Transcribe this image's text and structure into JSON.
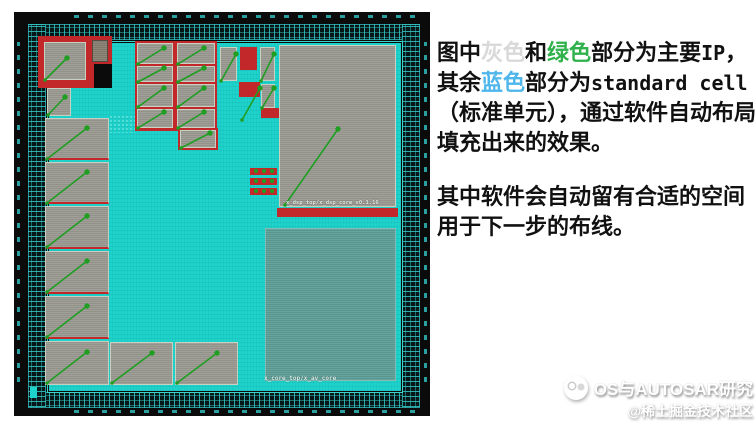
{
  "article": {
    "p1_runs": [
      {
        "text": "图中"
      },
      {
        "text": "灰色",
        "color": "#d9d9d9"
      },
      {
        "text": "和"
      },
      {
        "text": "绿色",
        "color": "#2fb14c"
      },
      {
        "text": "部分为主要"
      },
      {
        "text": "IP",
        "mono": true
      },
      {
        "text": "，其余"
      },
      {
        "text": "蓝色",
        "color": "#4fb6ec"
      },
      {
        "text": "部分为"
      },
      {
        "text": "standard cell",
        "mono": true
      },
      {
        "text": "（标准单元），通过软件自动布局填充出来的效果。"
      }
    ],
    "p2": "其中软件会自动留有合适的空间用于下一步的布线。"
  },
  "watermark": {
    "brand": "OS与AUTOSAR研究",
    "handle": "@稀土掘金技术社区"
  },
  "chip": {
    "colors": {
      "die_black": "#0b0b0b",
      "core_cyan": "#1ed3cb",
      "macro_gray": "#9b9b93",
      "macro_dark": "#877f72",
      "sage": "#5f9f98",
      "red": "#c2282a",
      "green": "#1f9e22",
      "pad_teal": "#35c3c3"
    },
    "labels": {
      "top_block": "x_dsp_top/x_dsp_core_v0.1.16",
      "core_bottom": "x_core_top/x_av_core"
    },
    "red_shapes": [
      [
        24,
        24,
        74,
        38
      ],
      [
        24,
        56,
        58,
        20
      ],
      [
        121,
        29,
        82,
        90
      ],
      [
        164,
        116,
        40,
        22
      ],
      [
        226,
        35,
        17,
        23
      ],
      [
        225,
        70,
        21,
        15
      ],
      [
        247,
        96,
        20,
        10
      ],
      [
        263,
        196,
        121,
        9
      ]
    ],
    "black_shapes": [
      [
        80,
        52,
        18,
        24
      ]
    ],
    "blocks": [
      {
        "x": 30,
        "y": 30,
        "w": 42,
        "h": 38,
        "t": "macro"
      },
      {
        "x": 78,
        "y": 28,
        "w": 16,
        "h": 22,
        "t": "dark"
      },
      {
        "x": 33,
        "y": 76,
        "w": 24,
        "h": 28,
        "t": "macro"
      },
      {
        "x": 31,
        "y": 106,
        "w": 64,
        "h": 42,
        "t": "macro",
        "sep": true
      },
      {
        "x": 31,
        "y": 150,
        "w": 64,
        "h": 42,
        "t": "macro",
        "sep": true
      },
      {
        "x": 31,
        "y": 194,
        "w": 64,
        "h": 43,
        "t": "macro",
        "sep": true
      },
      {
        "x": 31,
        "y": 239,
        "w": 64,
        "h": 43,
        "t": "macro",
        "sep": true
      },
      {
        "x": 31,
        "y": 284,
        "w": 64,
        "h": 43,
        "t": "macro",
        "sep": true
      },
      {
        "x": 31,
        "y": 329,
        "w": 64,
        "h": 44,
        "t": "macro"
      },
      {
        "x": 96,
        "y": 330,
        "w": 63,
        "h": 43,
        "t": "macro"
      },
      {
        "x": 161,
        "y": 330,
        "w": 63,
        "h": 43,
        "t": "macro"
      },
      {
        "x": 123,
        "y": 31,
        "w": 36,
        "h": 21,
        "t": "macro"
      },
      {
        "x": 163,
        "y": 31,
        "w": 38,
        "h": 21,
        "t": "macro"
      },
      {
        "x": 123,
        "y": 54,
        "w": 36,
        "h": 16,
        "t": "macro"
      },
      {
        "x": 163,
        "y": 54,
        "w": 38,
        "h": 16,
        "t": "macro"
      },
      {
        "x": 123,
        "y": 72,
        "w": 36,
        "h": 23,
        "t": "macro"
      },
      {
        "x": 163,
        "y": 72,
        "w": 38,
        "h": 23,
        "t": "macro"
      },
      {
        "x": 123,
        "y": 97,
        "w": 36,
        "h": 19,
        "t": "macro"
      },
      {
        "x": 163,
        "y": 97,
        "w": 38,
        "h": 19,
        "t": "macro"
      },
      {
        "x": 166,
        "y": 118,
        "w": 36,
        "h": 18,
        "t": "macro"
      },
      {
        "x": 206,
        "y": 35,
        "w": 17,
        "h": 34,
        "t": "macro"
      },
      {
        "x": 246,
        "y": 35,
        "w": 15,
        "h": 34,
        "t": "macro"
      },
      {
        "x": 247,
        "y": 72,
        "w": 14,
        "h": 24,
        "t": "macro"
      },
      {
        "x": 265,
        "y": 33,
        "w": 117,
        "h": 162,
        "t": "big"
      },
      {
        "x": 251,
        "y": 216,
        "w": 131,
        "h": 153,
        "t": "sage"
      }
    ],
    "pad_cluster": {
      "bars": [
        [
          236,
          156,
          27,
          7
        ],
        [
          236,
          166,
          27,
          7
        ],
        [
          236,
          176,
          27,
          7
        ]
      ],
      "dots_dx": [
        4,
        12,
        20
      ]
    },
    "texture_patch": [
      95,
      103,
      26,
      18
    ],
    "arrows": [
      [
        31,
        68,
        53,
        46
      ],
      [
        34,
        103,
        51,
        85
      ],
      [
        33,
        147,
        73,
        116
      ],
      [
        33,
        191,
        73,
        160
      ],
      [
        33,
        235,
        73,
        204
      ],
      [
        33,
        280,
        73,
        249
      ],
      [
        33,
        325,
        73,
        294
      ],
      [
        33,
        371,
        73,
        340
      ],
      [
        98,
        371,
        138,
        341
      ],
      [
        163,
        371,
        203,
        341
      ],
      [
        124,
        52,
        150,
        36
      ],
      [
        164,
        52,
        190,
        36
      ],
      [
        124,
        70,
        150,
        56
      ],
      [
        164,
        70,
        190,
        56
      ],
      [
        124,
        95,
        150,
        76
      ],
      [
        164,
        95,
        190,
        76
      ],
      [
        124,
        116,
        150,
        100
      ],
      [
        164,
        116,
        190,
        100
      ],
      [
        167,
        136,
        196,
        121
      ],
      [
        207,
        69,
        222,
        42
      ],
      [
        247,
        69,
        260,
        42
      ],
      [
        248,
        96,
        260,
        76
      ],
      [
        228,
        108,
        246,
        76
      ],
      [
        271,
        193,
        324,
        117
      ]
    ]
  }
}
